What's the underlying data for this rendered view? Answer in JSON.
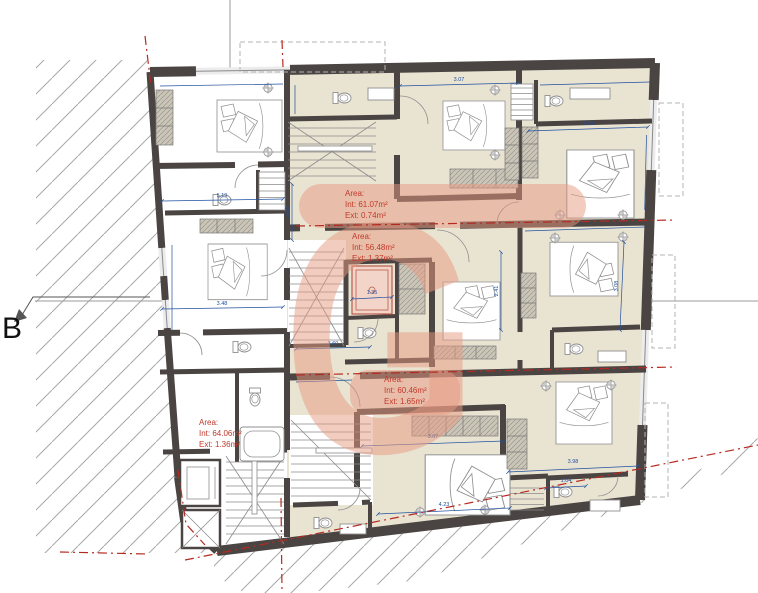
{
  "section_marker": {
    "label": "B"
  },
  "watermark": {
    "letter": "G"
  },
  "annotations": [
    {
      "label": "Area:",
      "int_value": "Int: 61.07m²",
      "ext_value": "Ext: 0.74m²"
    },
    {
      "label": "Area:",
      "int_value": "Int: 56.48m²",
      "ext_value": "Ext: 1.37m²"
    },
    {
      "label": "Area:",
      "int_value": "Int: 60.46m²",
      "ext_value": "Ext: 1.65m²"
    },
    {
      "label": "Area:",
      "int_value": "Int: 64.06m²",
      "ext_value": "Ext: 1.36m²"
    }
  ],
  "dimensions": [
    "3.07",
    "4.29",
    "5.19",
    "3.48",
    "2.00",
    "3.60",
    "1.35",
    "2.41",
    "4.23",
    "3.07",
    "3.98",
    "1.04",
    "3.08"
  ],
  "colors": {
    "wall": "#4a4543",
    "floor_beige": "#e9e3d2",
    "dim_blue": "#2050a0",
    "annotation_red": "#c0392b",
    "watermark_pink": "#e89a82",
    "boundary_red": "#b52a20",
    "hatch_gray": "#a8a8a8",
    "furniture_gray": "#8f8f8f",
    "line_gray": "#9b9b9b",
    "wardrobe_fill": "#cbc5b6",
    "shower_pink": "#f3d4c8"
  }
}
